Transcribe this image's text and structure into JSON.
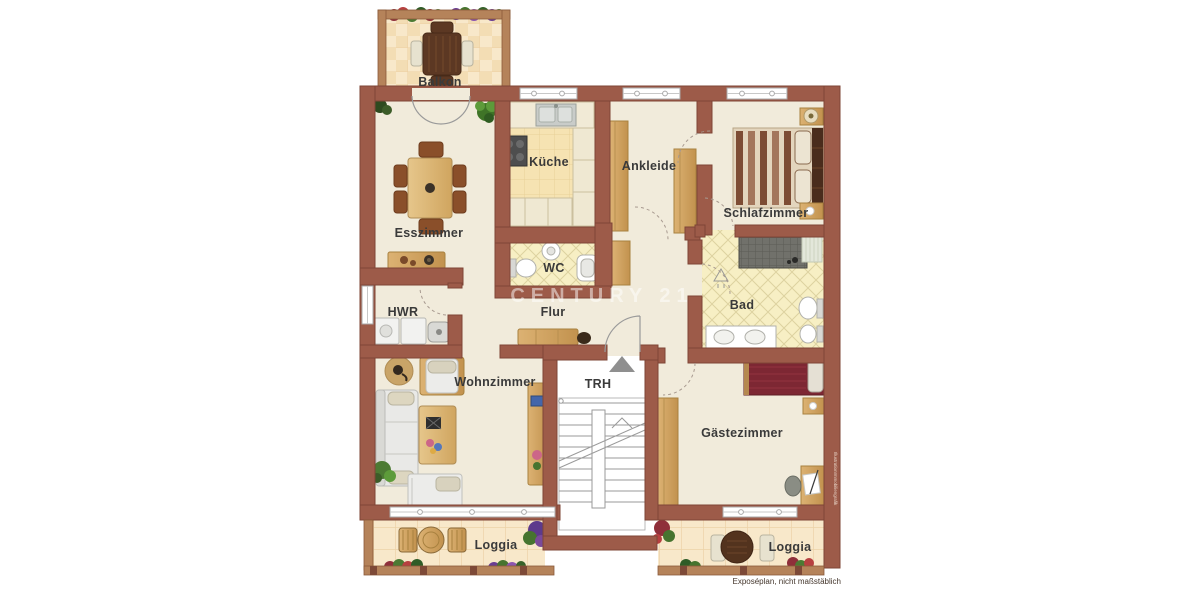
{
  "labels": {
    "balkon": "Balkon",
    "esszimmer": "Esszimmer",
    "kueche": "Küche",
    "ankleide": "Ankleide",
    "schlafzimmer": "Schlafzimmer",
    "wc": "WC",
    "flur": "Flur",
    "hwr": "HWR",
    "bad": "Bad",
    "wohnzimmer": "Wohnzimmer",
    "trh": "TRH",
    "gaestezimmer": "Gästezimmer",
    "loggia_left": "Loggia",
    "loggia_right": "Loggia"
  },
  "watermark": {
    "text": "CENTURY 21"
  },
  "notes": {
    "footer": "Exposéplan, nicht maßstäblich",
    "side_credit": "IllustrationImmobiliengrafik"
  },
  "colors": {
    "wall": "#9d5b49",
    "wall_edge": "#7e4536",
    "floor": "#f1ebdb",
    "tile_loggia": "#f8e8ca",
    "tile_kitchen": "#f6e3b2",
    "tile_bath": "#f7efc4",
    "stairwell": "#ffffff",
    "wood": "#cfa059",
    "bed_red": "#7d2733",
    "watermark_white": "#ffffff"
  }
}
